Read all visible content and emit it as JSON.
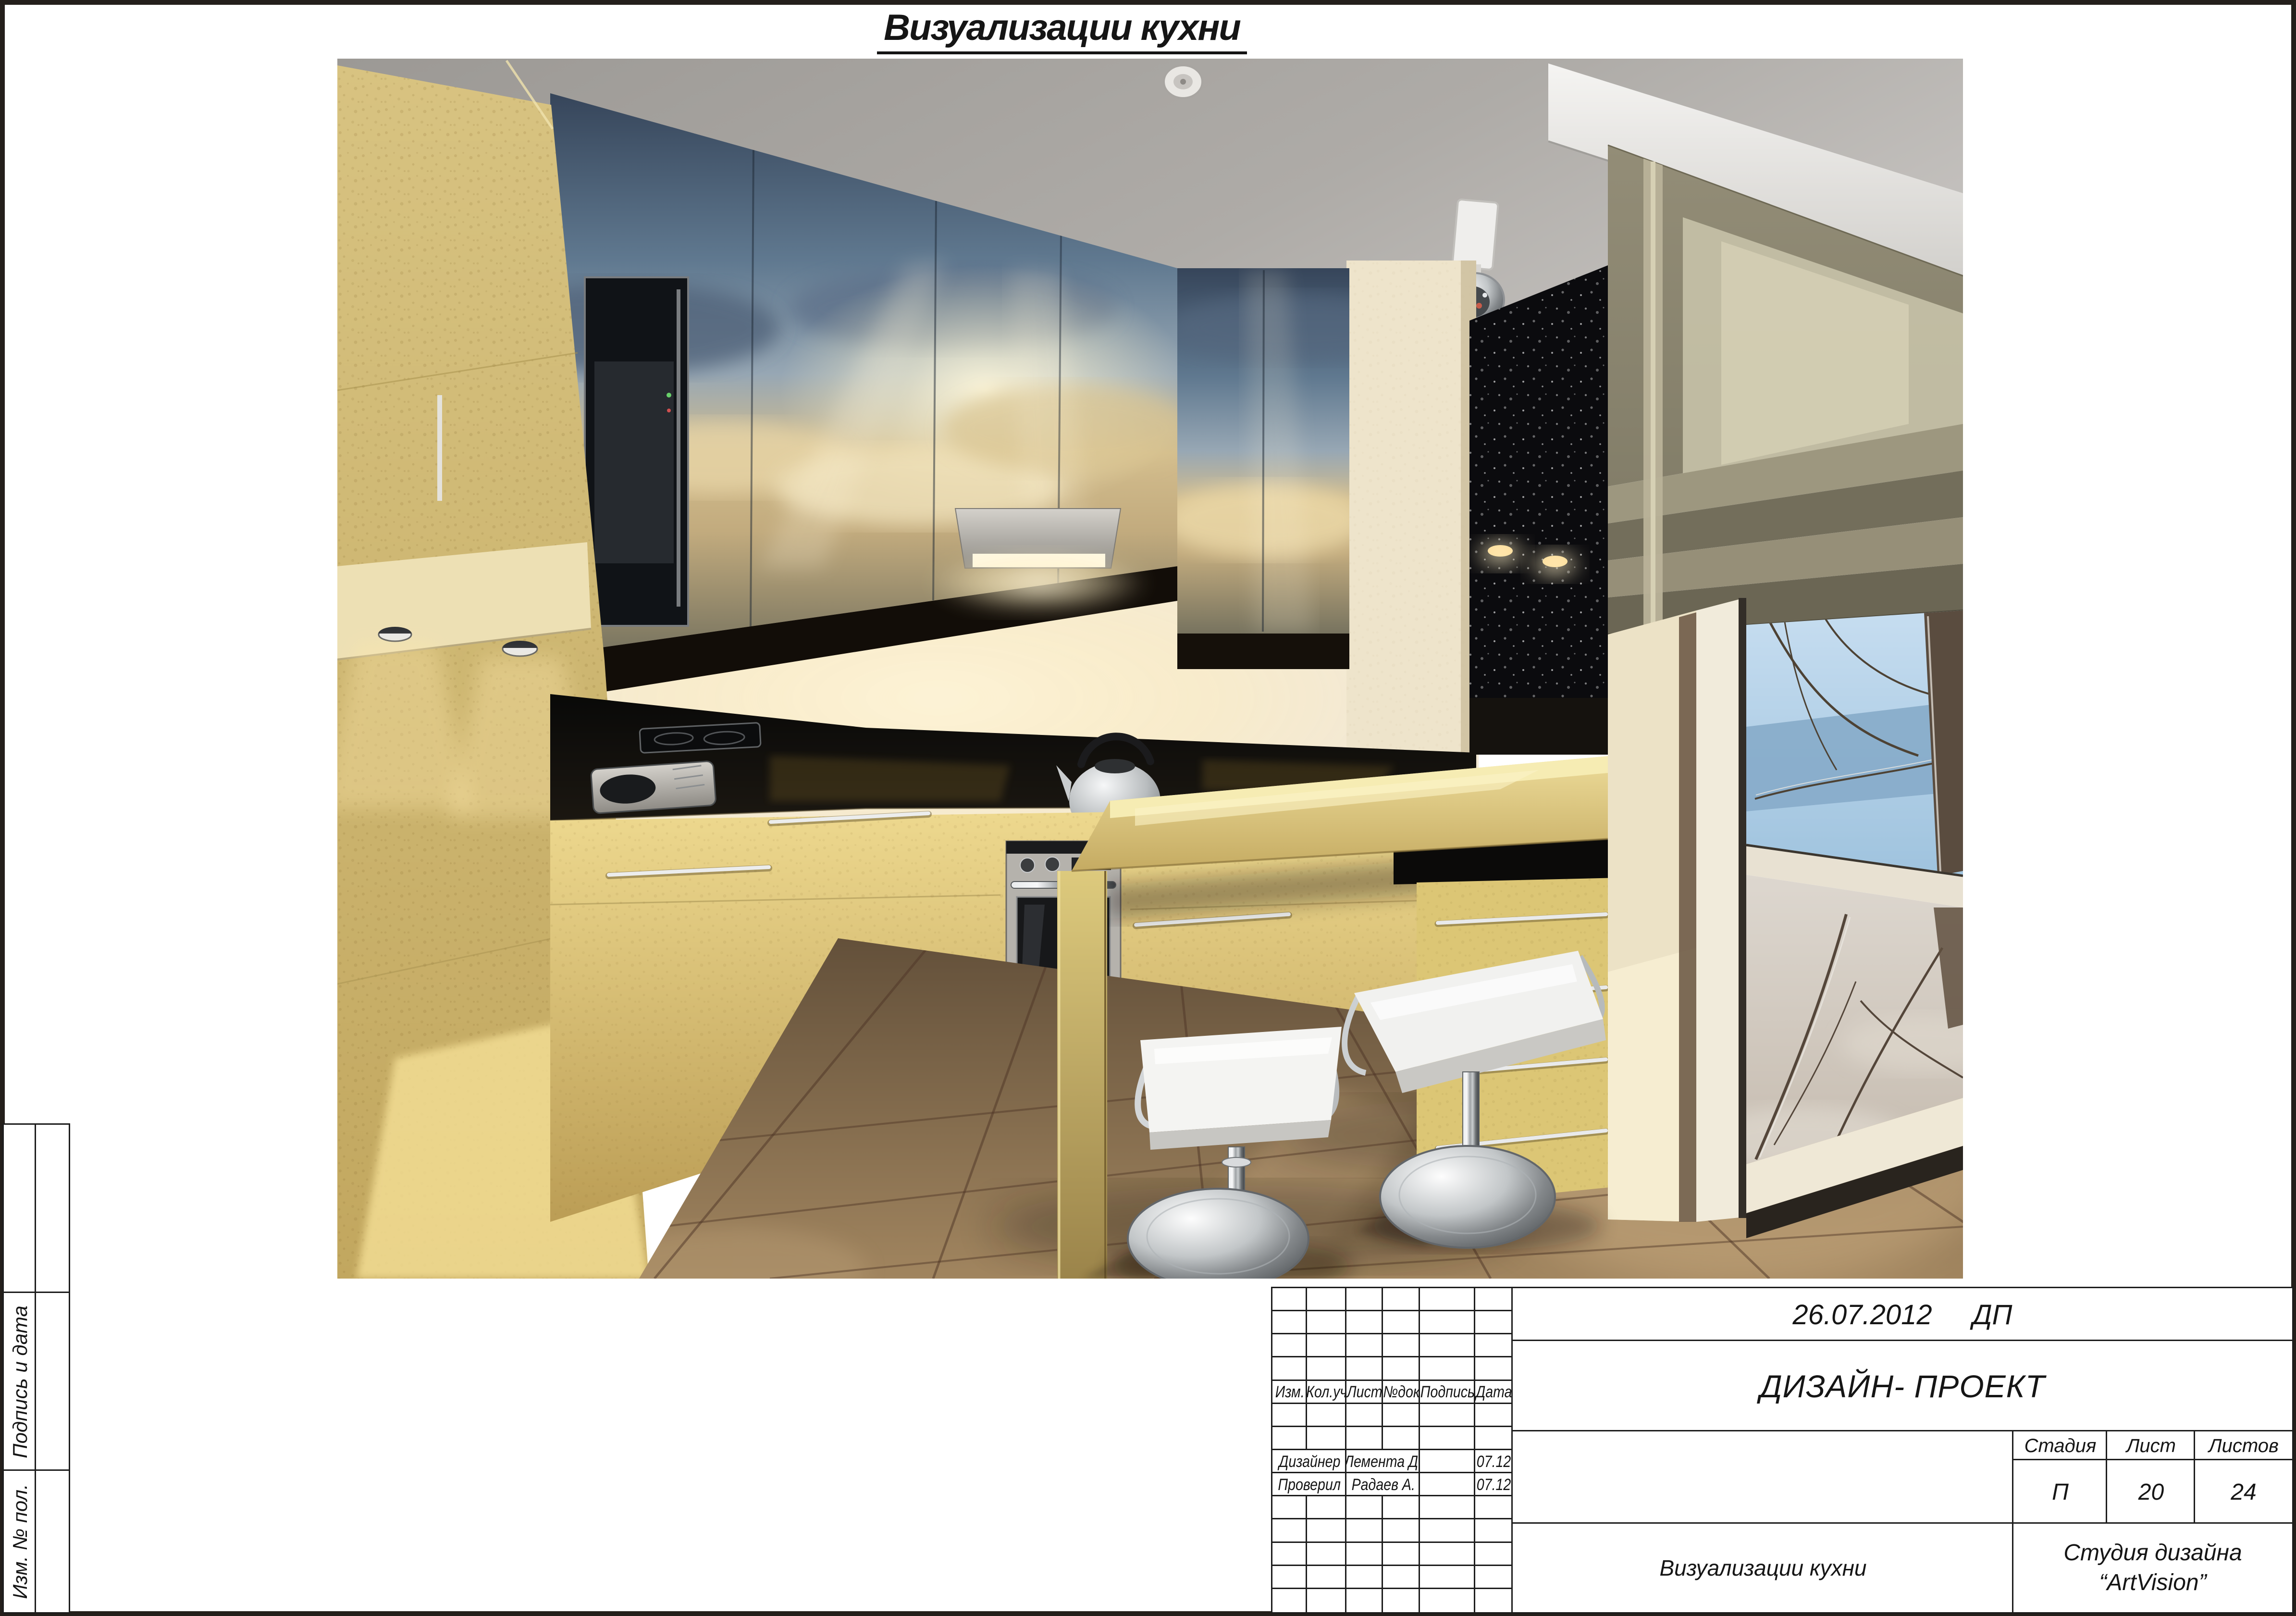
{
  "page": {
    "title": "Визуализации кухни"
  },
  "palette": {
    "line": "#1d1d1d",
    "cabinet_yellow": "#d2bb74",
    "sky_print_blue": "#5a7089",
    "sky_print_gold": "#d3bd8d",
    "counter_black": "#0c0b09",
    "blind_olive": "#8e8873",
    "floor_tan": "#8a7157",
    "winter_sky": "#b6d2e8",
    "ceiling_grey": "#aeaba7"
  },
  "titleblock": {
    "date": "26.07.2012",
    "stage_code": "ДП",
    "project": "ДИЗАЙН- ПРОЕКТ",
    "left_table": {
      "grid": [
        [
          {},
          {},
          {},
          {},
          {},
          {}
        ],
        [
          {},
          {},
          {},
          {},
          {},
          {}
        ],
        [
          {},
          {},
          {},
          {},
          {},
          {}
        ],
        [
          {},
          {},
          {},
          {},
          {},
          {}
        ],
        [
          {
            "t": "Изм."
          },
          {
            "t": "Кол.уч"
          },
          {
            "t": "Лист"
          },
          {
            "t": "№док"
          },
          {
            "t": "Подпись"
          },
          {
            "t": "Дата"
          }
        ],
        [
          {},
          {},
          {},
          {},
          {},
          {}
        ],
        [
          {},
          {},
          {},
          {},
          {},
          {}
        ],
        [
          {
            "t": "Дизайнер",
            "s": 2
          },
          {
            "t": "Лемента Д.",
            "s": 2
          },
          {},
          {
            "t": "07.12"
          }
        ],
        [
          {
            "t": "Проверил",
            "s": 2
          },
          {
            "t": "Радаев А.",
            "s": 2
          },
          {},
          {
            "t": "07.12"
          }
        ],
        [
          {},
          {},
          {},
          {},
          {},
          {}
        ],
        [
          {},
          {},
          {},
          {},
          {},
          {}
        ],
        [
          {},
          {},
          {},
          {},
          {},
          {}
        ],
        [
          {},
          {},
          {},
          {},
          {},
          {}
        ],
        [
          {},
          {},
          {},
          {},
          {},
          {}
        ]
      ]
    },
    "stage_table": {
      "headers": [
        "Стадия",
        "Лист",
        "Листов"
      ],
      "values": [
        "П",
        "20",
        "24"
      ]
    },
    "sheet_title": "Визуализации кухни",
    "studio_line1": "Студия дизайна",
    "studio_line2": "“ArtVision”"
  },
  "margin_labels": {
    "signature_date": "Подпись и дата",
    "inventory": "Изм. № пол."
  }
}
